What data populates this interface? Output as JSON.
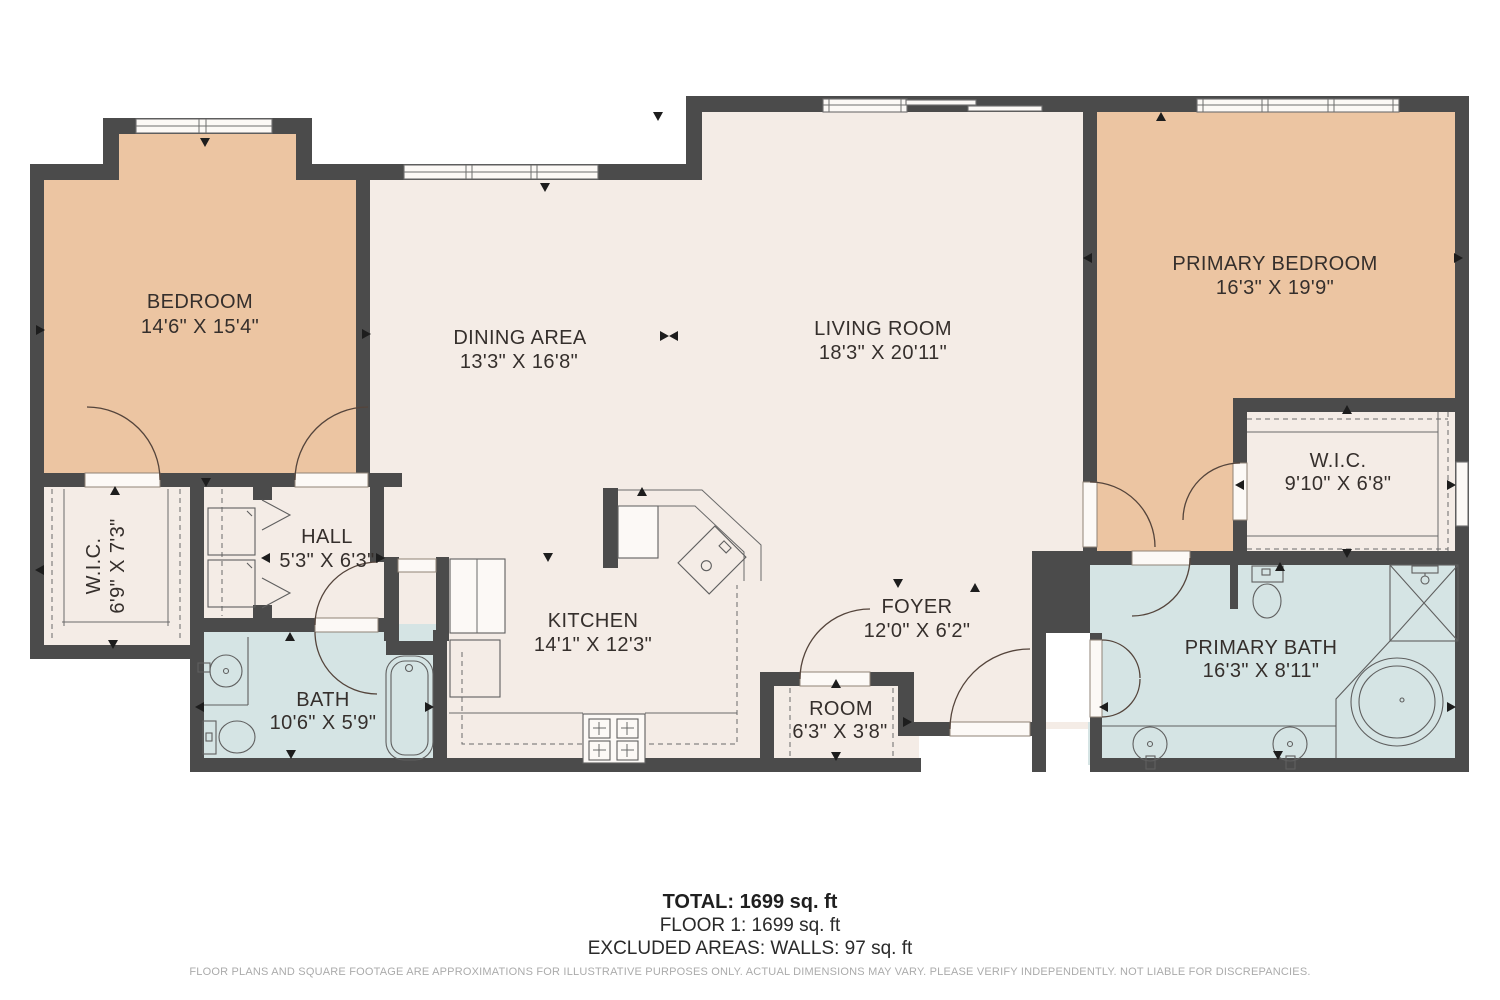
{
  "title": "Floor plan",
  "rooms": [
    {
      "id": "bedroom",
      "name": "BEDROOM",
      "dims": "14'6\" X 15'4\""
    },
    {
      "id": "dining-area",
      "name": "DINING AREA",
      "dims": "13'3\" X 16'8\""
    },
    {
      "id": "living-room",
      "name": "LIVING ROOM",
      "dims": "18'3\" X 20'11\""
    },
    {
      "id": "primary-bedroom",
      "name": "PRIMARY BEDROOM",
      "dims": "16'3\" X 19'9\""
    },
    {
      "id": "wic-left",
      "name": "W.I.C.",
      "dims": "6'9\" X 7'3\""
    },
    {
      "id": "hall",
      "name": "HALL",
      "dims": "5'3\" X 6'3\""
    },
    {
      "id": "kitchen",
      "name": "KITCHEN",
      "dims": "14'1\" X 12'3\""
    },
    {
      "id": "foyer",
      "name": "FOYER",
      "dims": "12'0\" X 6'2\""
    },
    {
      "id": "room",
      "name": "ROOM",
      "dims": "6'3\" X 3'8\""
    },
    {
      "id": "wic-right",
      "name": "W.I.C.",
      "dims": "9'10\" X 6'8\""
    },
    {
      "id": "bath",
      "name": "BATH",
      "dims": "10'6\" X 5'9\""
    },
    {
      "id": "primary-bath",
      "name": "PRIMARY BATH",
      "dims": "16'3\" X 8'11\""
    }
  ],
  "summary": {
    "total": "TOTAL: 1699 sq. ft",
    "floor": "FLOOR 1: 1699 sq. ft",
    "excluded": "EXCLUDED AREAS: WALLS: 97 sq. ft"
  },
  "disclaimer": "FLOOR PLANS AND SQUARE FOOTAGE ARE APPROXIMATIONS FOR ILLUSTRATIVE PURPOSES ONLY. ACTUAL DIMENSIONS MAY VARY. PLEASE VERIFY INDEPENDENTLY. NOT LIABLE FOR DISCREPANCIES.",
  "colors": {
    "wall": "#4b4b4b",
    "floor_main": "#f4ece6",
    "floor_bedroom": "#ecc5a2",
    "floor_bath": "#d5e4e4",
    "door_leaf": "#fcf9f6",
    "label_text": "#352f2c",
    "disclaimer_text": "#ababab"
  }
}
